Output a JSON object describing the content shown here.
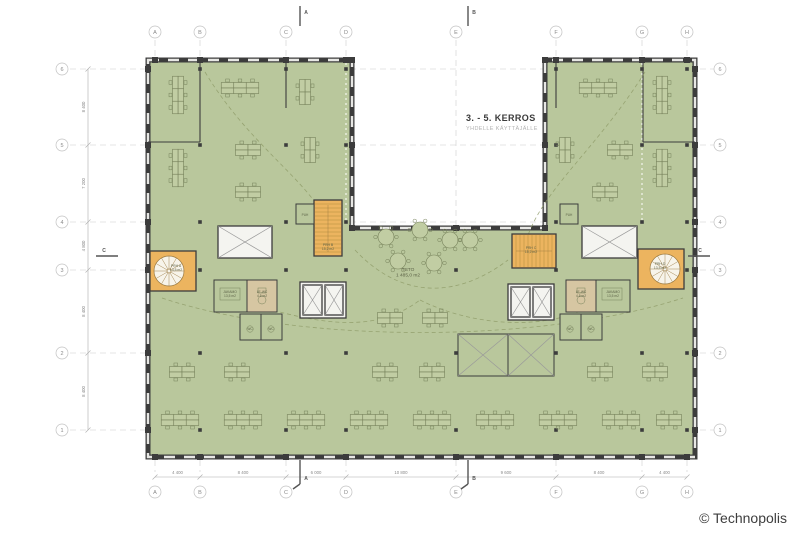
{
  "drawing": {
    "title": "3. - 5. KERROS",
    "subtitle": "YHDELLE KÄYTTÄJÄLLE",
    "copyright": "© Technopolis"
  },
  "grid": {
    "columns": [
      "A",
      "B",
      "C",
      "D",
      "E",
      "F",
      "G",
      "H"
    ],
    "rows": [
      "6",
      "5",
      "4",
      "3",
      "2",
      "1"
    ],
    "column_dims": [
      "4 400",
      "8 400",
      "6 000",
      "10 800",
      "9 600",
      "8 400",
      "4 400"
    ],
    "row_dims": [
      "8 400",
      "7 200",
      "4 800",
      "8 400",
      "8 400"
    ]
  },
  "sections": {
    "a": "A",
    "b": "B",
    "c": "C"
  },
  "rooms": {
    "tsto": {
      "name": "TSTO",
      "area": "1 485,0 m2"
    },
    "prh_a": {
      "name": "PRH A",
      "area": "13,5 m2"
    },
    "prh_b": {
      "name": "PRH B",
      "area": "15,2 m2"
    },
    "prh_c": {
      "name": "PRH C",
      "area": "15,2 m2"
    },
    "prh_d": {
      "name": "PRH D",
      "area": "13,5 m2"
    },
    "jakamo_l": {
      "name": "JAKAMO",
      "area": "13,5 m2"
    },
    "lewc_l": {
      "name": "LE-WC",
      "area": "4,5 m2"
    },
    "jakamo_r": {
      "name": "JAKAMO",
      "area": "13,5 m2"
    },
    "lewc_r": {
      "name": "LE-WC",
      "area": "4,5 m2"
    },
    "wc": {
      "name": "WC"
    },
    "puh": {
      "name": "PUH"
    }
  },
  "colors": {
    "floor": "#b9c79c",
    "stair": "#ecb45f",
    "wet": "#d6c6a2",
    "wall": "#3c3c3c",
    "grid": "#cdcdcd",
    "text": "#3a3a3a",
    "muted": "#9a9a9a"
  }
}
